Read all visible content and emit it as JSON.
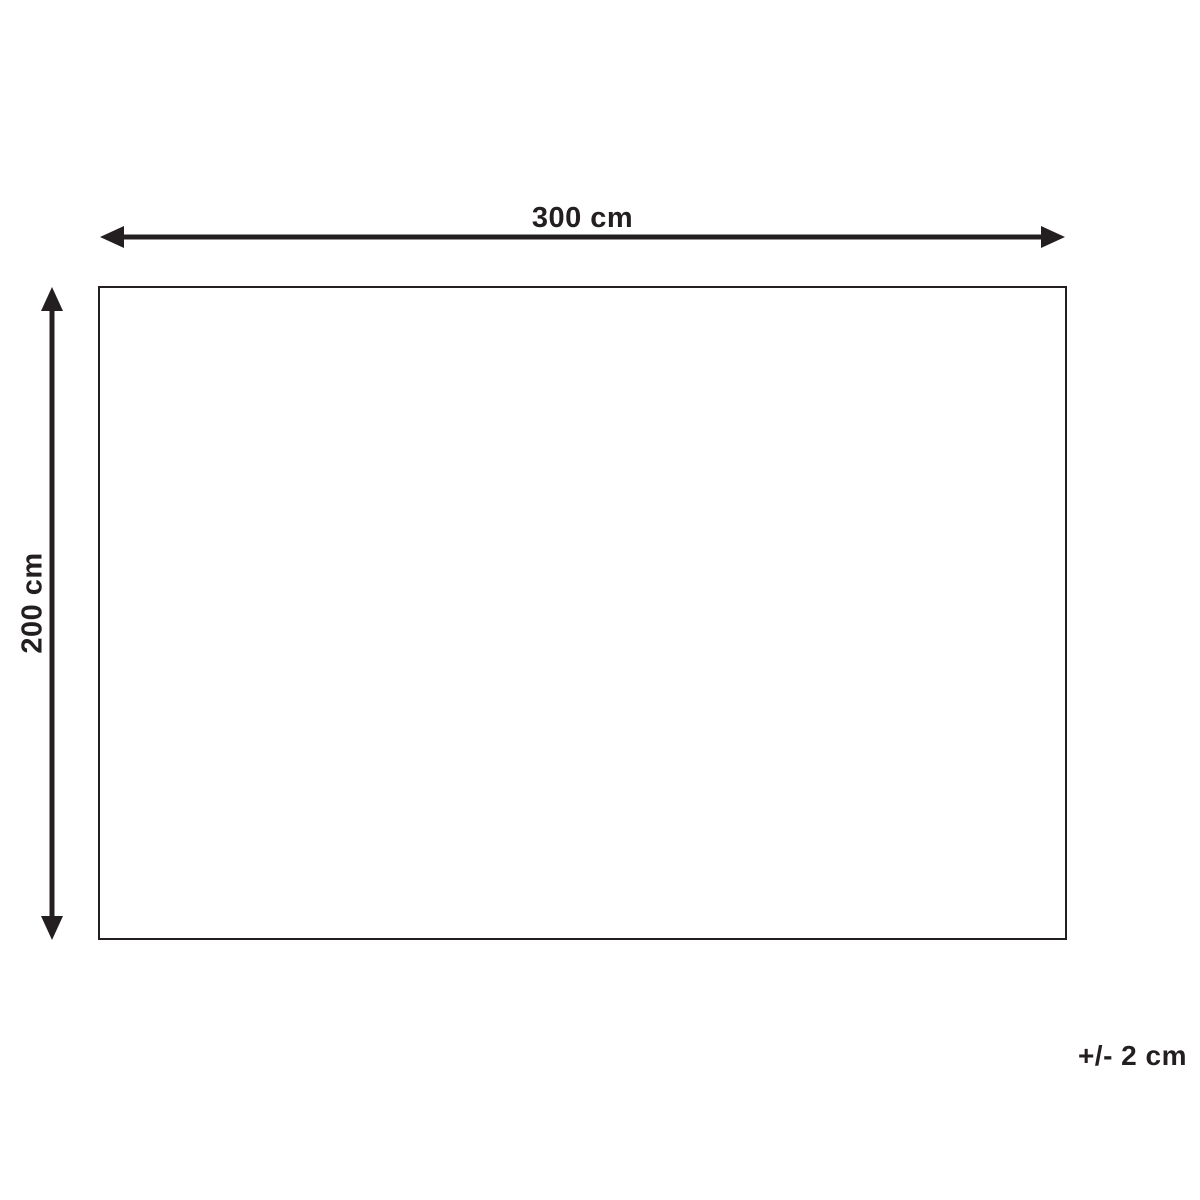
{
  "diagram": {
    "type": "product-dimension-diagram",
    "width_label": "300 cm",
    "height_label": "200 cm",
    "tolerance_label": "+/- 2 cm",
    "ink_color": "#231f20",
    "background_color": "#ffffff"
  }
}
